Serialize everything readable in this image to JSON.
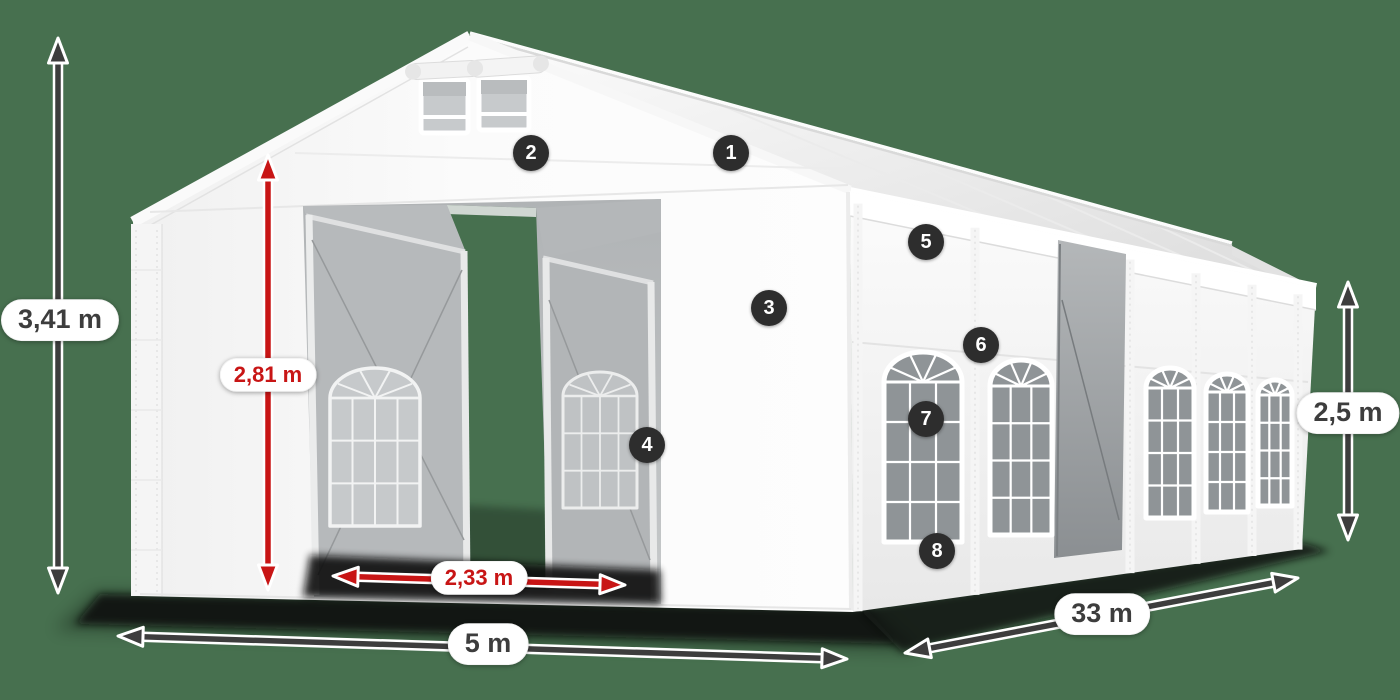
{
  "scene": {
    "background_color": "#47704f",
    "description": "White marquee tent 360-view diagram with dimension arrows and numbered part markers"
  },
  "colors": {
    "accent_red": "#c81515",
    "annotation_dark": "#3d3d3d",
    "pill_background": "#ffffff",
    "marker_background": "#2d2d2d",
    "marker_text": "#ffffff",
    "tent_white": "#fafafa"
  },
  "dimensions": {
    "total_height": {
      "label": "3,41 m"
    },
    "entrance_height": {
      "label": "2,81 m"
    },
    "entrance_width": {
      "label": "2,33 m"
    },
    "front_width": {
      "label": "5 m"
    },
    "side_length": {
      "label": "33 m"
    },
    "side_height": {
      "label": "2,5 m"
    }
  },
  "markers": [
    {
      "label": "1"
    },
    {
      "label": "2"
    },
    {
      "label": "3"
    },
    {
      "label": "4"
    },
    {
      "label": "5"
    },
    {
      "label": "6"
    },
    {
      "label": "7"
    },
    {
      "label": "8"
    }
  ]
}
